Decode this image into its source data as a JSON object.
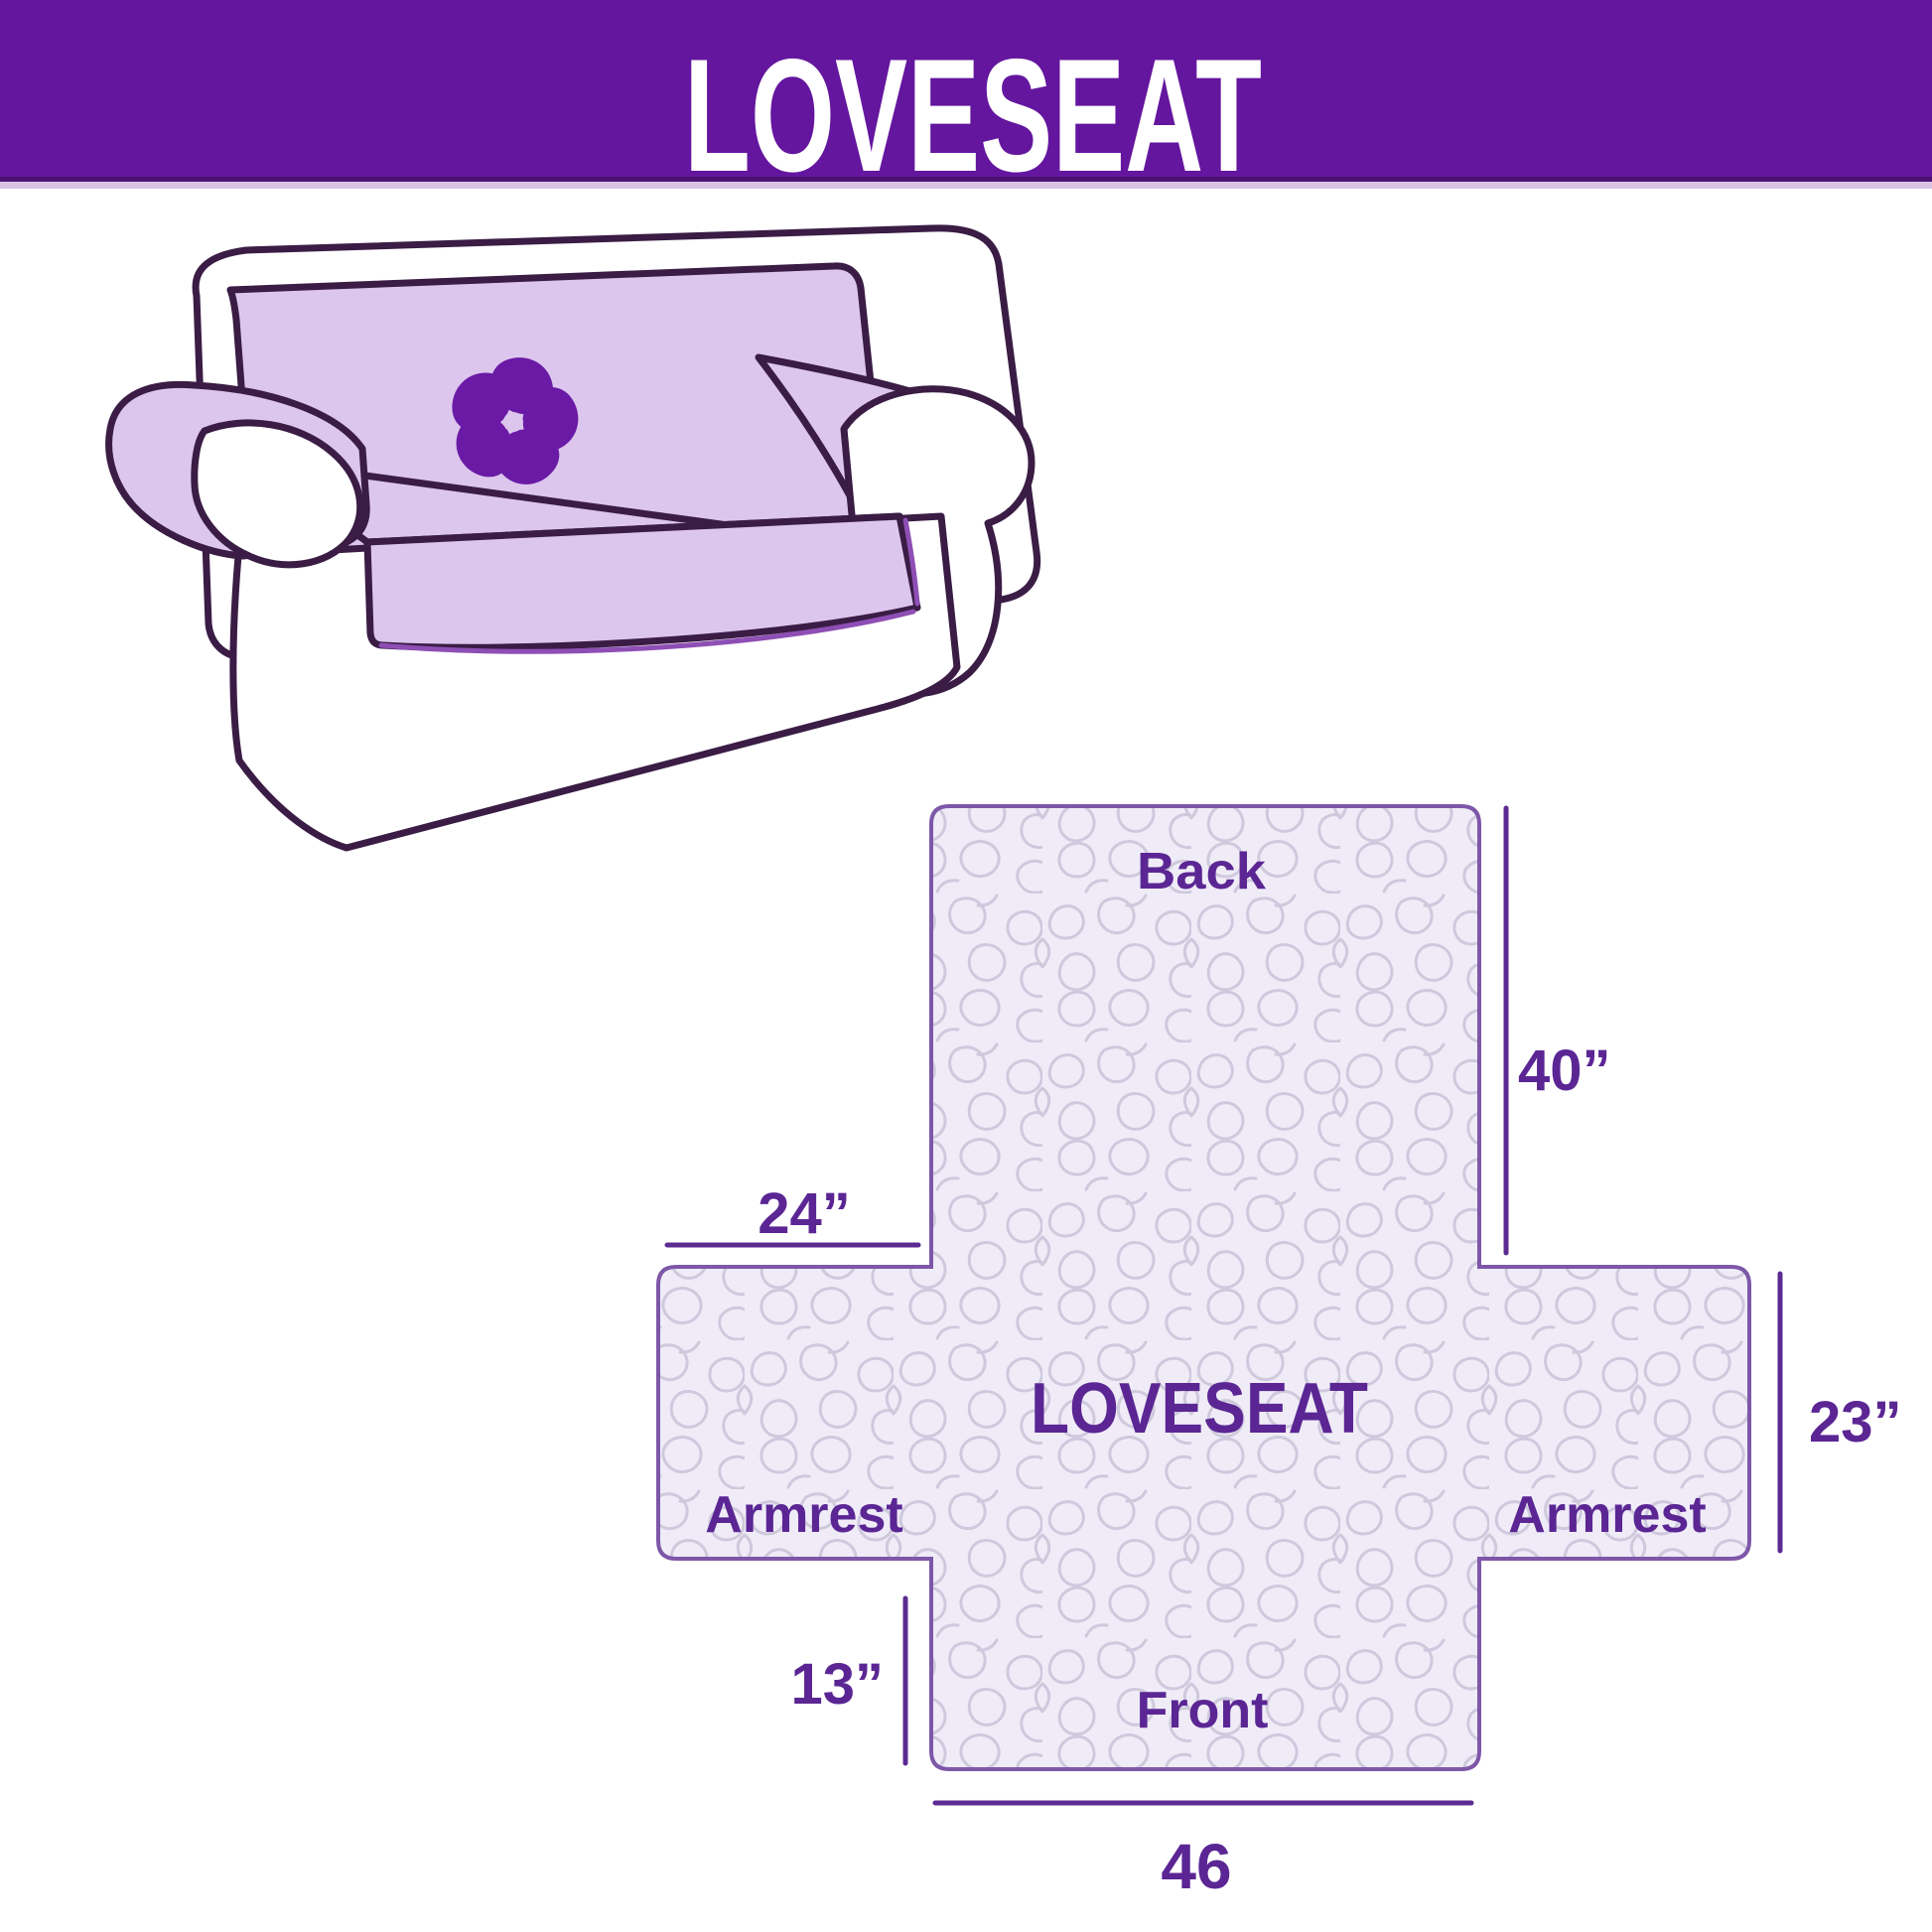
{
  "page": {
    "banner_title": "LOVESEAT"
  },
  "colors": {
    "banner_bg": "#64169f",
    "banner_edge": "#4a1172",
    "banner_underline": "#d9c2e6",
    "banner_text": "#ffffff",
    "cover_fill": "#dcc6ee",
    "sofa_outline": "#3a1c45",
    "logo": "#6a1aa5",
    "hem": "#8e4fb5",
    "quilt_bg": "#efecf7",
    "quilt_line": "#cfc9dd",
    "diagram_outline": "#7e57a8",
    "diagram_text": "#5b2694",
    "dimension_line": "#5b2b92"
  },
  "illustration": {
    "logo_icon": "pinwheel-icon"
  },
  "diagram": {
    "labels": {
      "back": "Back",
      "center": "LOVESEAT",
      "armrest_left": "Armrest",
      "armrest_right": "Armrest",
      "front": "Front"
    },
    "dimensions": {
      "back_height": "40”",
      "armrest_top_width": "24”",
      "armrest_side_height": "23”",
      "front_flap_height": "13”",
      "front_width": "46"
    }
  }
}
